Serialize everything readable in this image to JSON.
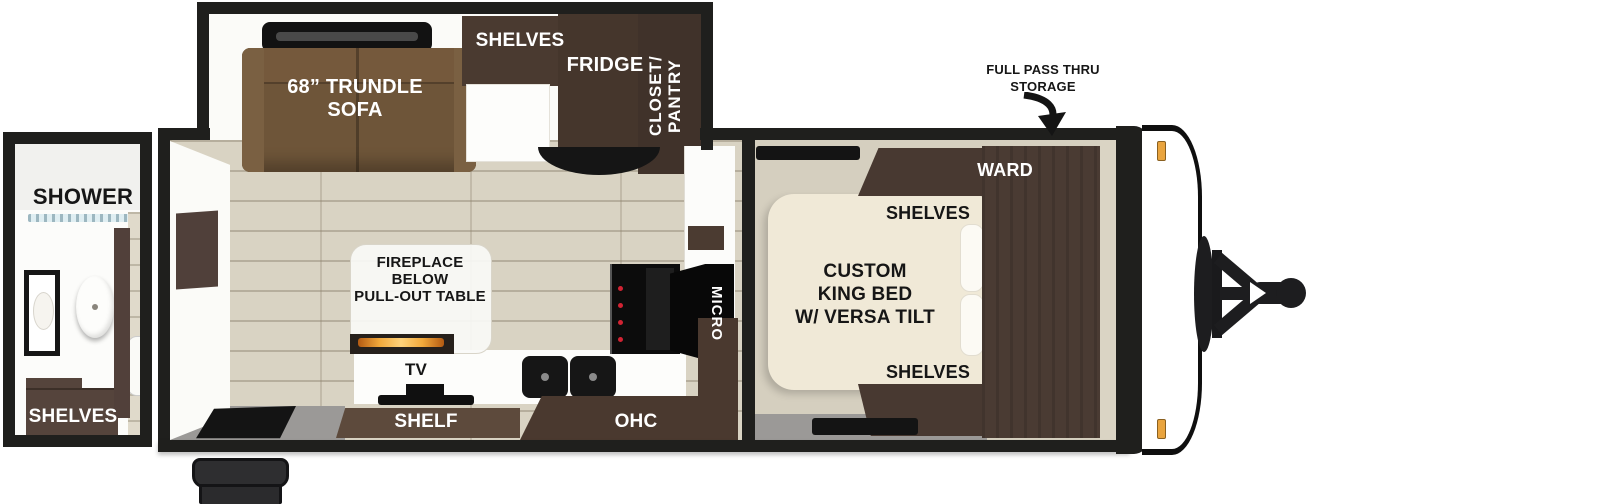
{
  "title": "Travel trailer floor plan",
  "callouts": {
    "pass_thru": "FULL PASS THRU\nSTORAGE"
  },
  "rear_bath": {
    "shower": "SHOWER",
    "shelves": "SHELVES"
  },
  "slideout": {
    "sofa": "68” TRUNDLE\nSOFA",
    "shelves": "SHELVES",
    "fridge": "FRIDGE",
    "closet": "CLOSET/\nPANTRY"
  },
  "living": {
    "fireplace": "FIREPLACE\nBELOW\nPULL-OUT TABLE",
    "tv": "TV",
    "shelf": "SHELF"
  },
  "kitchen": {
    "ohc": "OHC",
    "micro": "MICRO"
  },
  "bedroom": {
    "bed": "CUSTOM\nKING BED\nW/ VERSA TILT",
    "ward": "WARD",
    "shelves_top": "SHELVES",
    "shelves_bottom": "SHELVES"
  },
  "colors": {
    "wall": "#1f1f1d",
    "floor": "#d9d3c3",
    "floor_gray": "#9b9997",
    "sofa": "#6e5539",
    "cabinet_dark": "#46372e",
    "cabinet_mid": "#5d4a3c",
    "bed": "#f0e9d7",
    "marker_light": "#e9a43e",
    "flame": "#f2a93b"
  }
}
